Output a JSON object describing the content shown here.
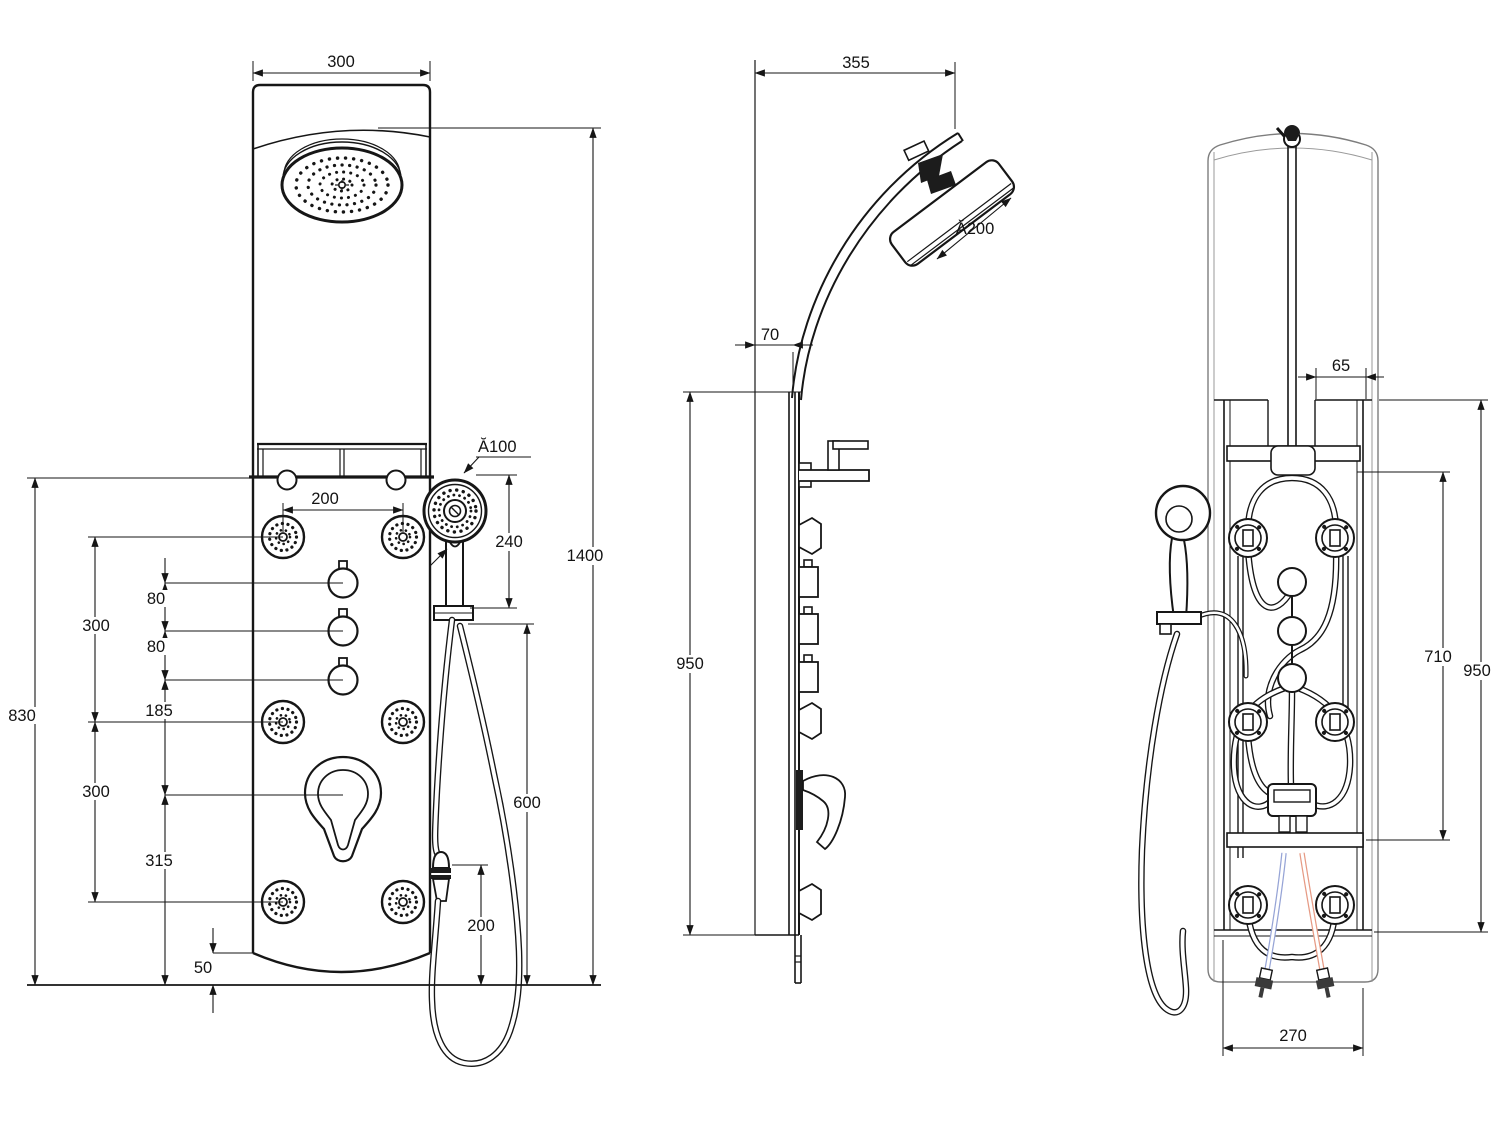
{
  "drawing": {
    "front": {
      "panel_width": "300",
      "jet_spacing": "200",
      "handshower_diameter": "Ă100",
      "handshower_offset": "240",
      "total_height": "1400",
      "knob_gap_top": "80",
      "knob_gap_bottom": "80",
      "jet_span_upper": "300",
      "knob_to_mixer": "185",
      "jet_span_lower": "300",
      "mixer_to_base": "315",
      "body_height": "830",
      "base_lip": "50",
      "hose_drop": "600",
      "hose_clearance": "200"
    },
    "side": {
      "arm_reach": "355",
      "panel_depth": "70",
      "head_diameter": "Ă200",
      "panel_height": "950"
    },
    "back": {
      "pipe_to_edge": "65",
      "bracket_span": "710",
      "panel_height": "950",
      "base_width": "270"
    }
  }
}
